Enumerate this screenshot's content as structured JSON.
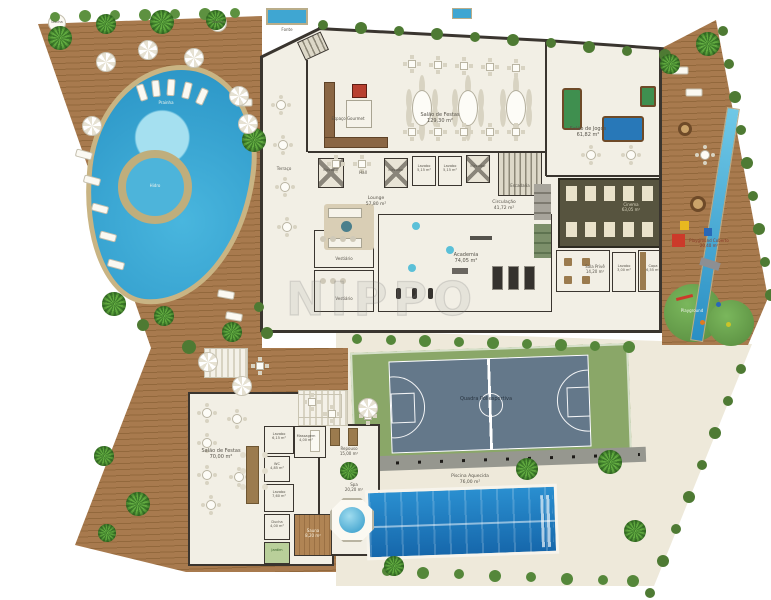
{
  "watermark": "NIPPO",
  "outdoor": {
    "ducha": "Ducha",
    "prainha": "Prainha",
    "hidro": "Hidro",
    "fonte": "Fonte",
    "quadra": {
      "name": "Quadra Poliesportiva"
    },
    "piscina_aquecida": {
      "name": "Piscina Aquecida",
      "area": "76,00 m²"
    },
    "playground_coberto": {
      "name": "Playground Coberto",
      "area": "20,40 m²"
    },
    "playground": {
      "name": "Playground"
    }
  },
  "building_main": {
    "terraco": {
      "name": "Terraço"
    },
    "espaco_gourmet": {
      "name": "Espaço Gourmet"
    },
    "salao_festas": {
      "name": "Salão de Festas",
      "area": "129,30 m²"
    },
    "elevador": "Elevador",
    "hall": "Hall",
    "lavabo": {
      "name": "Lavabo",
      "area": "5,15 m²"
    },
    "escadaria": "Escadaria",
    "circulacao": {
      "name": "Circulação",
      "area": "41,72 m²"
    },
    "lounge": {
      "name": "Lounge",
      "area": "57,80 m²"
    },
    "vestiario": {
      "name": "Vestiário"
    },
    "academia": {
      "name": "Academia",
      "area": "74,05 m²"
    },
    "cinema": {
      "name": "Cinema",
      "area": "63,05 m²"
    },
    "sala_prive": {
      "name": "Sala Privê",
      "area": "14,20 m²"
    },
    "lavabo2": {
      "name": "Lavabo",
      "area": "3,00 m²"
    },
    "copa": {
      "name": "Copa",
      "area": "6,55 m²"
    },
    "salao_jogos": {
      "name": "Salão de Jogos",
      "area": "61,82 m²"
    }
  },
  "building_spa": {
    "salao_festas": {
      "name": "Salão de Festas",
      "area": "70,00 m²"
    },
    "lavabo": {
      "name": "Lavabo",
      "area": "6,15 m²"
    },
    "massagem": {
      "name": "Massagem",
      "area": "4,00 m²"
    },
    "wc": {
      "name": "WC",
      "area": "4,85 m²"
    },
    "lavabo2": {
      "name": "Lavabo",
      "area": "7,60 m²"
    },
    "ducha": {
      "name": "Ducha",
      "area": "4,00 m²"
    },
    "jardim": {
      "name": "Jardim"
    },
    "sauna": {
      "name": "Sauna",
      "area": "8,20 m²"
    },
    "repouso": {
      "name": "Repouso",
      "area": "15,00 m²"
    },
    "spa": {
      "name": "Spa",
      "area": "20,20 m²"
    }
  },
  "colors": {
    "deck_wood": "#a0734a",
    "pool_water": "#37a7d4",
    "lap_pool": "#1e7cc0",
    "court_surface": "#64788a",
    "court_surround": "#8aa768",
    "floor": "#f2efe5",
    "wall": "#3a352f",
    "grass": "#69a14a"
  }
}
